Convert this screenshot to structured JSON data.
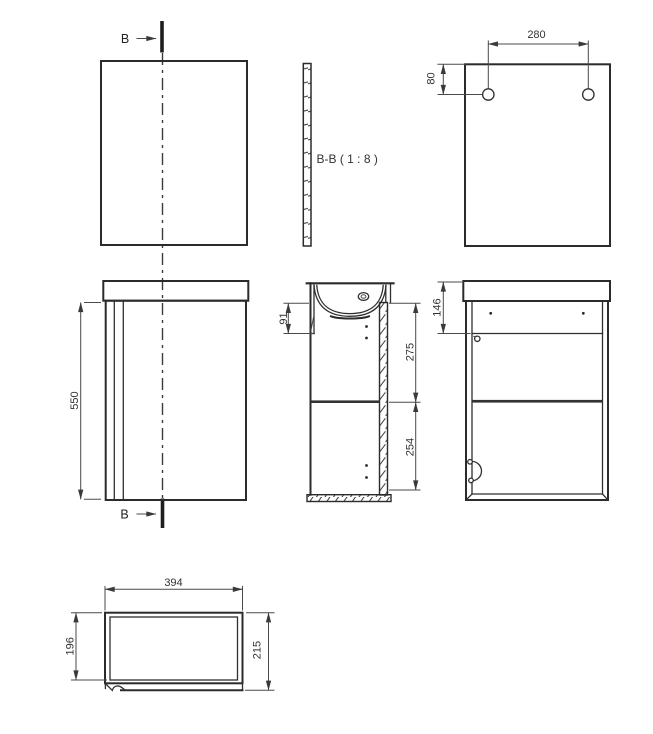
{
  "section_marks": {
    "letter": "B"
  },
  "section_view": {
    "label": "B-B ( 1 : 8 )"
  },
  "dims": {
    "hole_spacing": "280",
    "hole_top_offset": "80",
    "cabinet_height": "550",
    "basin_front_height": "91",
    "door_upper": "275",
    "door_lower": "254",
    "top_rail_height": "146",
    "cabinet_width": "394",
    "inner_depth": "196",
    "overall_depth": "215"
  },
  "colors": {
    "outline": "#2b2b2b",
    "thin_line": "#4a4a4a",
    "background": "#ffffff"
  }
}
